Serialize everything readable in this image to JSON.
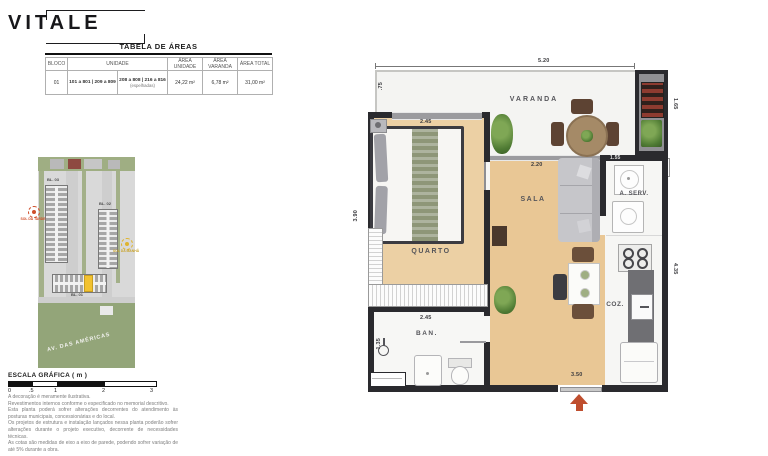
{
  "logo": {
    "text": "VITALE"
  },
  "areas_table": {
    "title": "TABELA DE ÁREAS",
    "col_bloco": "BLOCO",
    "col_unidade": "UNIDADE",
    "col_area_unidade": "ÁREA UNIDADE",
    "col_area_varanda": "ÁREA VARANDA",
    "col_area_total": "ÁREA TOTAL",
    "bloco": "01",
    "unidade_a": "101 a 801 | 209 a 809",
    "unidade_b": "208 a 808 | 216 a 816",
    "unidade_b_note": "(espelhadas)",
    "area_unidade": "24,22 m²",
    "area_varanda": "6,78 m²",
    "area_total": "31,00 m²"
  },
  "site_map": {
    "bl03": "BL. 03",
    "bl02": "BL. 02",
    "bl01": "BL. 01",
    "sun_afternoon": "SOL DA TARDE",
    "sun_morning": "SOL DA MANHÃ",
    "street": "AV. DAS AMÉRICAS",
    "colors": {
      "highlight_unit": "#f2c230",
      "sun_afternoon": "#cf4e2a",
      "sun_morning": "#dfb42f"
    }
  },
  "scale_bar": {
    "title": "ESCALA GRÁFICA ( m )",
    "ticks": [
      "0",
      ".5",
      "1",
      "2",
      "3"
    ]
  },
  "disclaimer": [
    "A decoração é meramente ilustrativa.",
    "Revestimentos internos conforme o especificado no memorial descritivo.",
    "Esta planta poderá sofrer alterações decorrentes do atendimento às posturas municipais, concessionárias e do local.",
    "Os projetos de estrutura e instalação lançados nessa planta poderão sofrer alterações durante o projeto executivo, decorrente de necessidades técnicas.",
    "As cotas são medidas de eixo a eixo de parede, podendo sofrer variação de até 5% durante a obra."
  ],
  "plan": {
    "rooms": {
      "varanda": "VARANDA",
      "quarto": "QUARTO",
      "sala": "SALA",
      "aserv": "A. SERV.",
      "coz": "COZ.",
      "ban": "BAN."
    },
    "dims": {
      "top": "5.20",
      "varanda_left": ".75",
      "utility_right": "1.65",
      "quarto_w": "2.45",
      "quarto_h": "3.90",
      "sala_w": "2.20",
      "aserv_w": "1.55",
      "coz_h": "4.35",
      "ban_w": "2.45",
      "ban_h": "1.35",
      "entry": "3.50"
    },
    "colors": {
      "entry_arrow": "#bf4e2e",
      "wall": "#2a2a2e"
    }
  }
}
